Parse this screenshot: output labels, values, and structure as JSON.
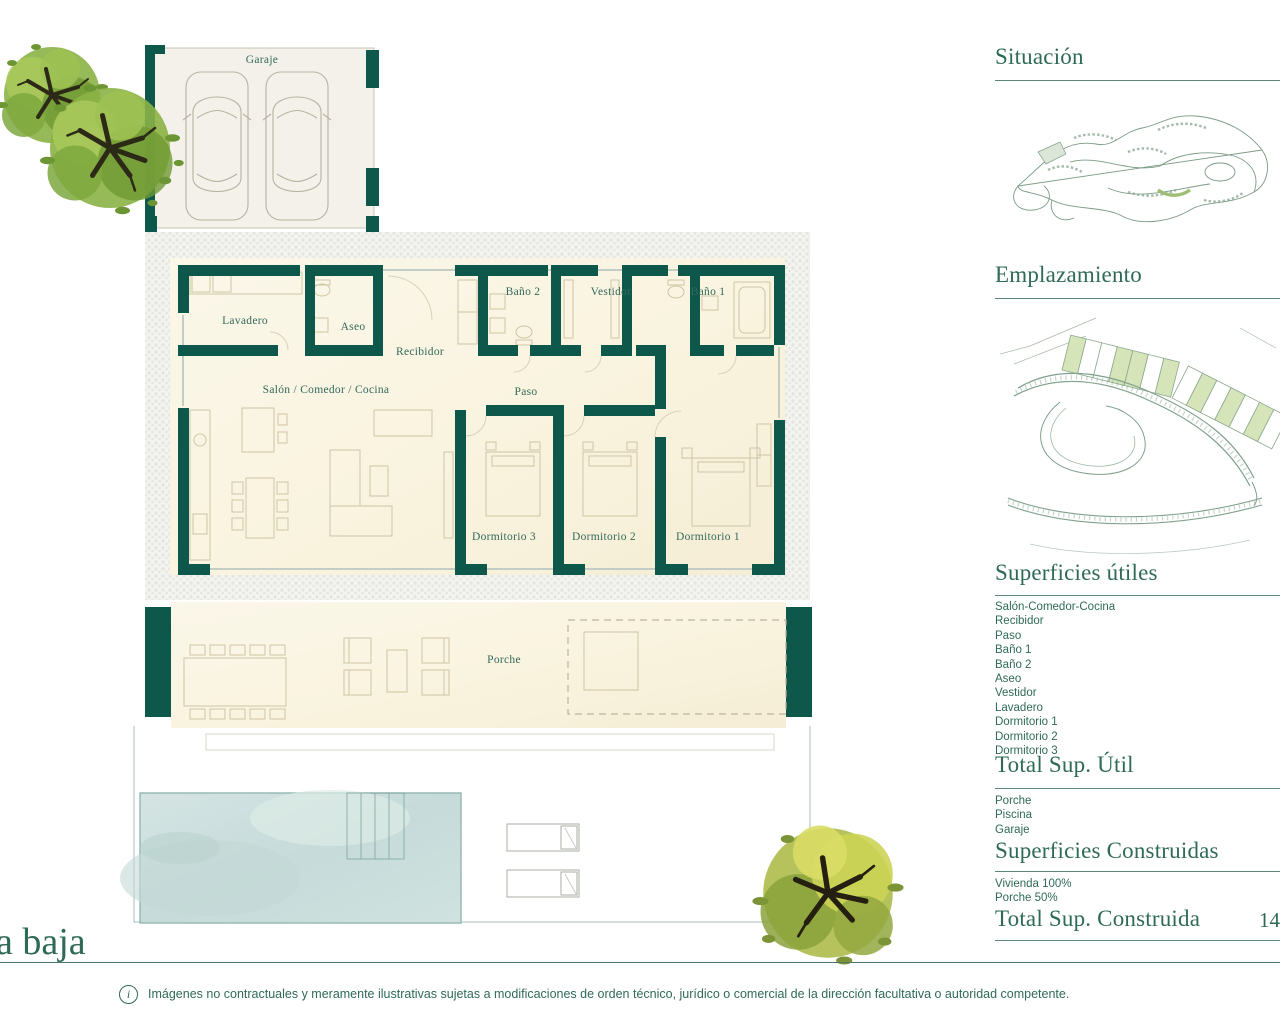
{
  "floorplan": {
    "plan_title": "a baja",
    "rooms": {
      "garaje": "Garaje",
      "lavadero": "Lavadero",
      "aseo": "Aseo",
      "recibidor": "Recibidor",
      "salon": "Salón / Comedor / Cocina",
      "bano2": "Baño 2",
      "vestidor": "Vestidor",
      "bano1": "Baño 1",
      "paso": "Paso",
      "dormitorio3": "Dormitorio 3",
      "dormitorio2": "Dormitorio 2",
      "dormitorio1": "Dormitorio 1",
      "porche": "Porche"
    }
  },
  "sidebar": {
    "situacion": {
      "title": "Situación"
    },
    "emplazamiento": {
      "title": "Emplazamiento"
    },
    "superficies_utiles": {
      "title": "Superficies útiles",
      "items": [
        "Salón-Comedor-Cocina",
        "Recibidor",
        "Paso",
        "Baño 1",
        "Baño 2",
        "Aseo",
        "Vestidor",
        "Lavadero",
        "Dormitorio 1",
        "Dormitorio 2",
        "Dormitorio 3"
      ]
    },
    "total_util": {
      "title": "Total Sup. Útil",
      "items": [
        "Porche",
        "Piscina",
        "Garaje"
      ]
    },
    "superficies_construidas": {
      "title": "Superficies Construidas",
      "items": [
        "Vivienda 100%",
        "Porche 50%"
      ]
    },
    "total_construida": {
      "title": "Total Sup. Construida",
      "value": "14"
    }
  },
  "footer": {
    "info_icon": "i",
    "disclaimer": "Imágenes no contractuales y meramente ilustrativas sujetas a modificaciones de orden técnico, jurídico o comercial de la dirección facultativa o autoridad competente."
  },
  "colors": {
    "wall_teal": "#0d584a",
    "heading_green": "#2f6a58",
    "floor_cream": "#faf5e2",
    "pool_blue": "#cfe2e2",
    "plot_green": "#d6e4ba"
  }
}
